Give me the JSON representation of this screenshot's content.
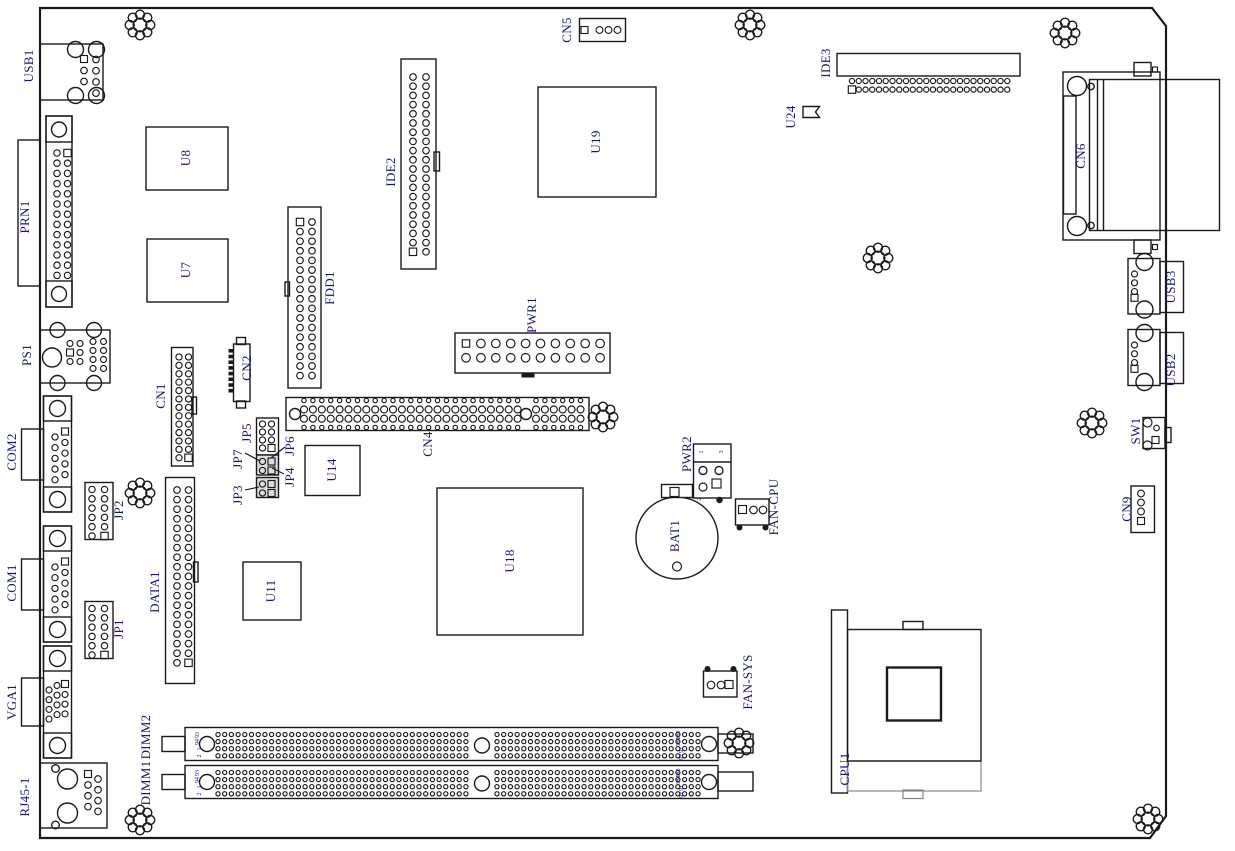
{
  "diagram": {
    "type": "motherboard-component-layout",
    "background": "#ffffff"
  },
  "colors": {
    "line": "#1a1a1a",
    "label": "#15157a"
  },
  "components": [
    {
      "id": "usb1",
      "label": "USB1"
    },
    {
      "id": "prn1",
      "label": "PRN1"
    },
    {
      "id": "ps1",
      "label": "PS1"
    },
    {
      "id": "com2",
      "label": "COM2"
    },
    {
      "id": "com1",
      "label": "COM1"
    },
    {
      "id": "vga1",
      "label": "VGA1"
    },
    {
      "id": "rj45-1",
      "label": "RJ45-1"
    },
    {
      "id": "jp2",
      "label": "JP2"
    },
    {
      "id": "jp1",
      "label": "JP1"
    },
    {
      "id": "cn1",
      "label": "CN1"
    },
    {
      "id": "data1",
      "label": "DATA1"
    },
    {
      "id": "u8",
      "label": "U8"
    },
    {
      "id": "u7",
      "label": "U7"
    },
    {
      "id": "fdd1",
      "label": "FDD1"
    },
    {
      "id": "ide2",
      "label": "IDE2"
    },
    {
      "id": "cn2",
      "label": "CN2"
    },
    {
      "id": "jp5",
      "label": "JP5"
    },
    {
      "id": "jp7",
      "label": "JP7"
    },
    {
      "id": "jp6",
      "label": "JP6"
    },
    {
      "id": "jp3",
      "label": "JP3"
    },
    {
      "id": "jp4",
      "label": "JP4"
    },
    {
      "id": "cn4",
      "label": "CN4"
    },
    {
      "id": "pwr1",
      "label": "PWR1"
    },
    {
      "id": "cn5",
      "label": "CN5"
    },
    {
      "id": "u19",
      "label": "U19"
    },
    {
      "id": "ide3",
      "label": "IDE3"
    },
    {
      "id": "u24",
      "label": "U24"
    },
    {
      "id": "cn6",
      "label": "CN6"
    },
    {
      "id": "usb3",
      "label": "USB3"
    },
    {
      "id": "usb2",
      "label": "USB2"
    },
    {
      "id": "sw1",
      "label": "SW1"
    },
    {
      "id": "cn9",
      "label": "CN9"
    },
    {
      "id": "pwr2",
      "label": "PWR2"
    },
    {
      "id": "bat1",
      "label": "BAT1"
    },
    {
      "id": "fan-cpu",
      "label": "FAN-CPU"
    },
    {
      "id": "fan-sys",
      "label": "FAN-SYS"
    },
    {
      "id": "cpu1",
      "label": "CPU1"
    },
    {
      "id": "dimm2",
      "label": "DIMM2"
    },
    {
      "id": "dimm1",
      "label": "DIMM1"
    },
    {
      "id": "u18",
      "label": "U18"
    },
    {
      "id": "u11",
      "label": "U11"
    },
    {
      "id": "u14",
      "label": "U14"
    }
  ],
  "pin_numbers": [
    "93",
    "94",
    "1",
    "2",
    "183",
    "184",
    "91",
    "92",
    "93",
    "94",
    "1",
    "2",
    "183",
    "184",
    "91",
    "92",
    "1",
    "3",
    "2"
  ]
}
